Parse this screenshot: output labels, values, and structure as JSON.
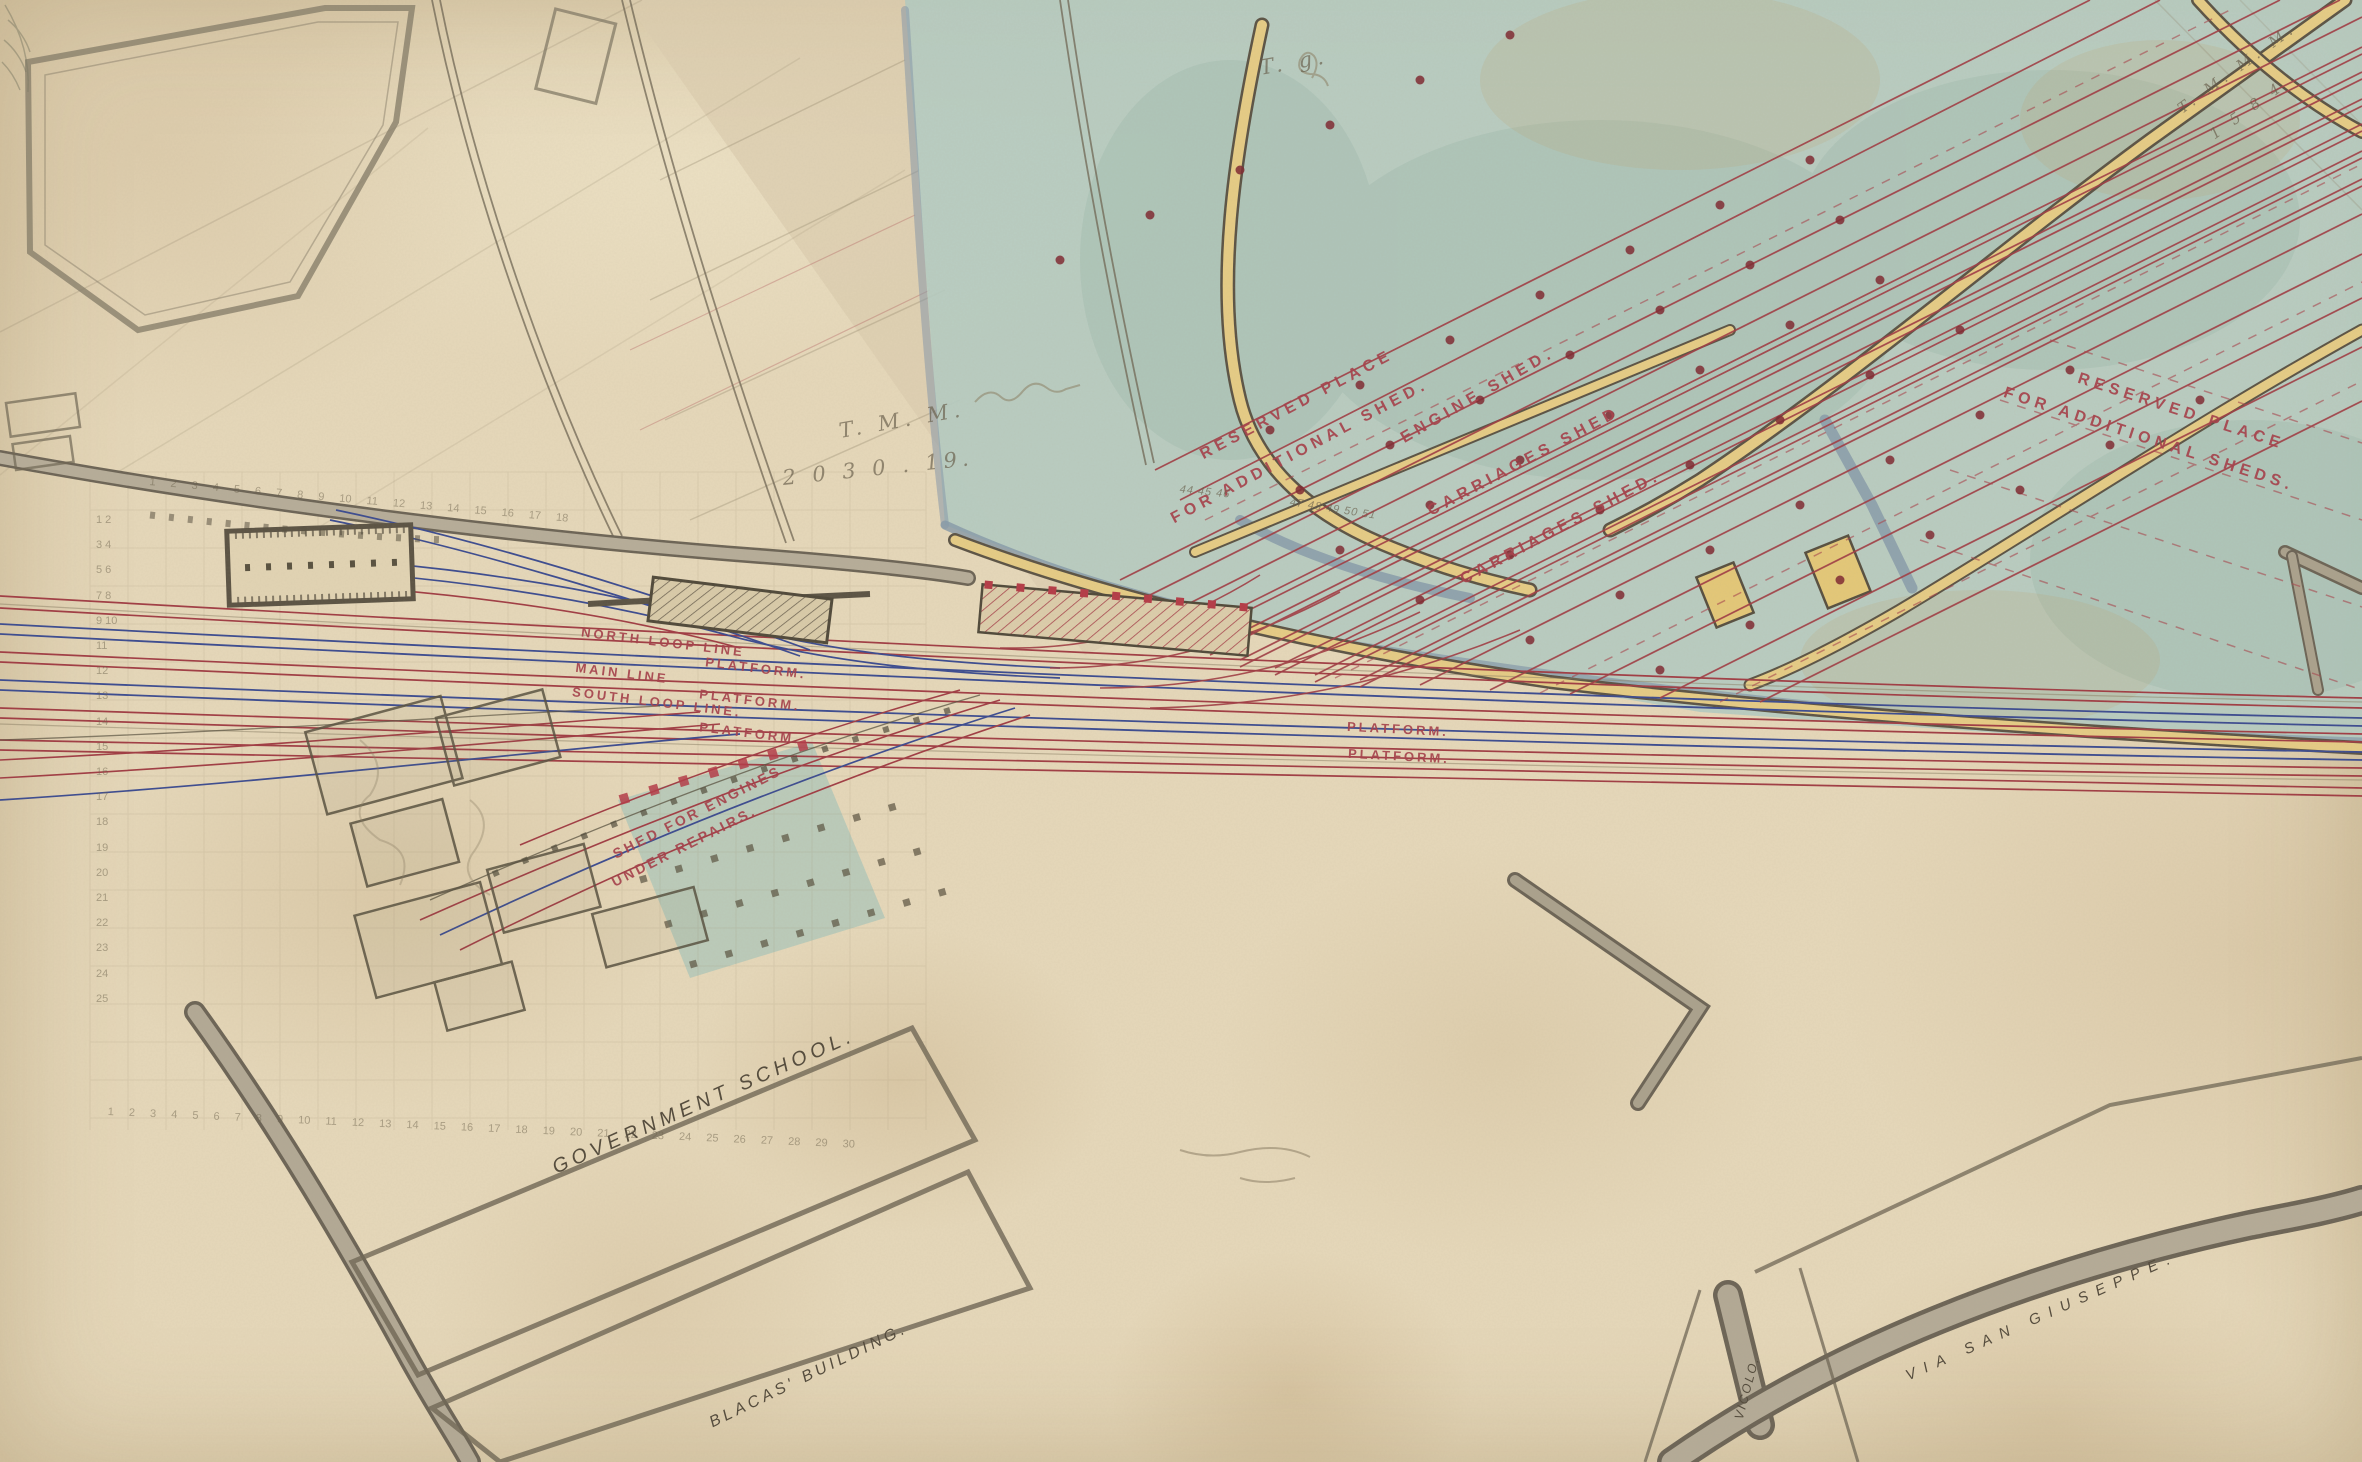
{
  "labels": {
    "reserved_left_1": "RESERVED PLACE",
    "reserved_left_2": "FOR ADDITIONAL SHED.",
    "engine_shed": "ENGINE SHED.",
    "carriages_shed_upper": "CARRIAGES SHED",
    "carriages_shed_lower": "CARRIAGES SHED.",
    "reserved_right_1": "RESERVED PLACE",
    "reserved_right_2": "FOR ADDITIONAL SHEDS.",
    "north_loop_line": "NORTH LOOP LINE",
    "main_line": "MAIN LINE",
    "south_loop_line": "SOUTH LOOP LINE.",
    "platform": "PLATFORM.",
    "shed_for_engines_1": "SHED FOR ENGINES",
    "shed_for_engines_2": "UNDER REPAIRS.",
    "government_school": "GOVERNMENT SCHOOL.",
    "blacas_building": "BLACAS' BUILDING.",
    "via_san_giuseppe": "VIA SAN GIUSEPPE.",
    "vicolo": "VICOLO."
  },
  "pencil_annotations": {
    "initials_center": "T. M. M.",
    "number_center": "2 0 3 0 . 19.",
    "initials_top_right": "T. M. M. M.",
    "number_top_right": "1 5 8 4",
    "mark_top_center": "T. g.",
    "chainage_a": "44 45 46",
    "chainage_b": "47 48 49 50 51",
    "grid_numbers_street": "1 2 3 4 5 6 7 8 9 10 11 12 13 14 15 16 17 18",
    "grid_numbers_bottom": "1 2 3 4 5 6 7 8 9 10 11 12 13 14 15 16 17 18 19 20 21 22 23 24 25 26 27 28 29 30",
    "grid_numbers_left": "1 2 3 4 5 6 7 8 9 10 11 12 13 14 15 16 17 18 19 20 21 22 23 24 25"
  },
  "colors": {
    "paper": "#e6d8ba",
    "teal_wash": "#b4cbc2",
    "slate_wall": "#8598a9",
    "road_yellow": "#e6cc85",
    "road_gray": "#b2a995",
    "track_red": "#a03b43",
    "track_blue": "#3a4a90",
    "label_red": "#a6444d",
    "ink_text": "#564d3e",
    "pencil": "#8a7d63",
    "column_dot_red": "#7e2730"
  }
}
